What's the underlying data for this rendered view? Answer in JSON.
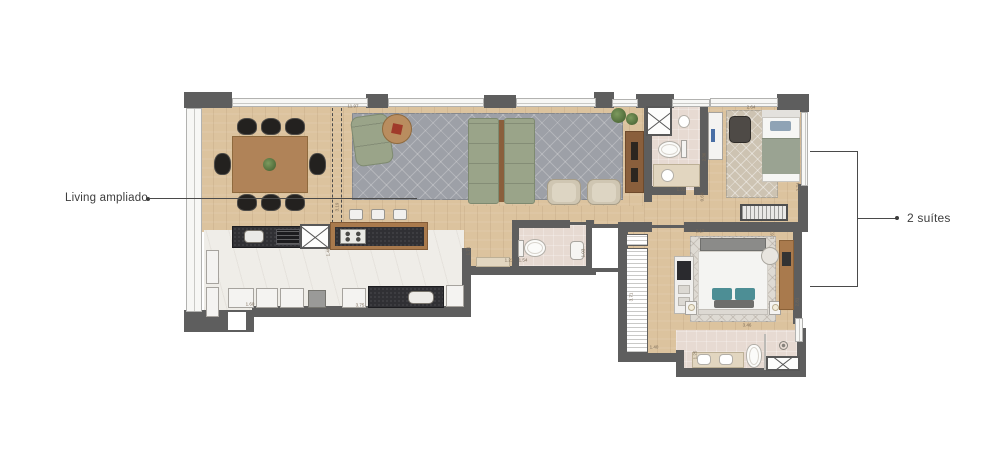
{
  "annotations": {
    "living": {
      "label": "Living ampliado"
    },
    "suites": {
      "label": "2 suítes"
    }
  },
  "dimensions": [
    {
      "text": "11.97",
      "x": 353,
      "y": 106,
      "vertical": false
    },
    {
      "text": "3.19",
      "x": 337,
      "y": 207,
      "vertical": true
    },
    {
      "text": "1.48",
      "x": 328,
      "y": 252,
      "vertical": true
    },
    {
      "text": "1.71",
      "x": 468,
      "y": 251,
      "vertical": true
    },
    {
      "text": "1.60",
      "x": 250,
      "y": 304,
      "vertical": false
    },
    {
      "text": "3.75",
      "x": 360,
      "y": 305,
      "vertical": false
    },
    {
      "text": "1.21",
      "x": 509,
      "y": 260,
      "vertical": false
    },
    {
      "text": "1.54",
      "x": 523,
      "y": 260,
      "vertical": false
    },
    {
      "text": "1.03",
      "x": 583,
      "y": 253,
      "vertical": true
    },
    {
      "text": "2.64",
      "x": 751,
      "y": 107,
      "vertical": false
    },
    {
      "text": "2.36",
      "x": 704,
      "y": 157,
      "vertical": true
    },
    {
      "text": "1.31",
      "x": 681,
      "y": 189,
      "vertical": false
    },
    {
      "text": "2.74",
      "x": 798,
      "y": 187,
      "vertical": true
    },
    {
      "text": "0.60",
      "x": 702,
      "y": 197,
      "vertical": true
    },
    {
      "text": "3.71",
      "x": 631,
      "y": 297,
      "vertical": true
    },
    {
      "text": "1.40",
      "x": 654,
      "y": 347,
      "vertical": false
    },
    {
      "text": "3.17",
      "x": 700,
      "y": 231,
      "vertical": false
    },
    {
      "text": "1.61",
      "x": 772,
      "y": 235,
      "vertical": true
    },
    {
      "text": "2.81",
      "x": 797,
      "y": 302,
      "vertical": true
    },
    {
      "text": "3.46",
      "x": 747,
      "y": 325,
      "vertical": false
    },
    {
      "text": "1.25",
      "x": 695,
      "y": 355,
      "vertical": true
    }
  ],
  "colors": {
    "wall": "#5e5e5e",
    "wood": "#dcc39e",
    "marble": "#efede8",
    "bath": "#e7dad2",
    "rug_gray": "#9da0a7",
    "rug_beige": "#cdc3b2",
    "rug_light": "#dedad3",
    "sofa": "#9aa489",
    "counter_dark": "#303034",
    "wood_furniture": "#a97a4d",
    "accent_teal": "#4d8e95",
    "label_text": "#3d3d3d"
  }
}
